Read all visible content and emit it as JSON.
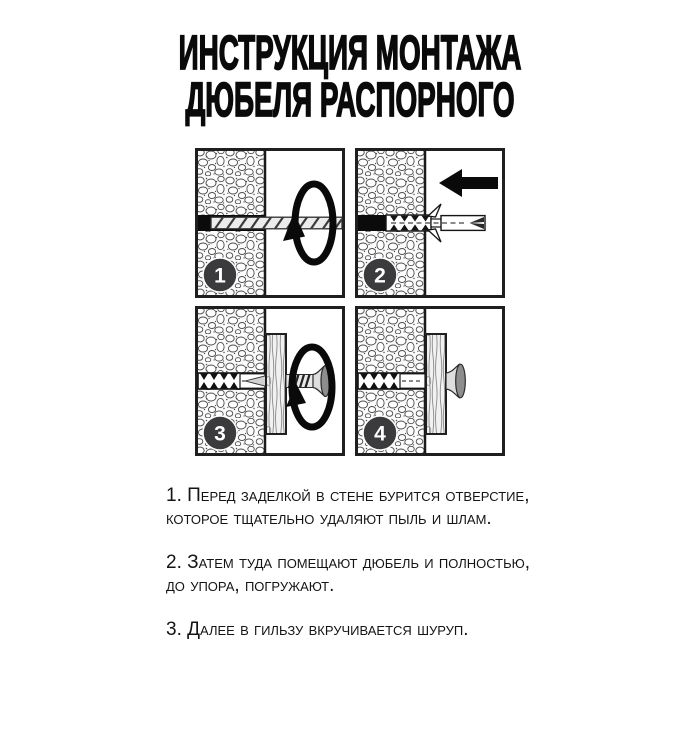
{
  "title": "ИНСТРУКЦИЯ МОНТАЖА\nДЮБЕЛЯ РАСПОРНОГО",
  "panels": [
    {
      "number": "1",
      "icon": "drill-bit-with-rotation-arrow"
    },
    {
      "number": "2",
      "icon": "dowel-with-push-arrow-left"
    },
    {
      "number": "3",
      "icon": "screw-into-dowel-with-rotation-arrow"
    },
    {
      "number": "4",
      "icon": "screw-fully-driven-flush"
    }
  ],
  "instructions": [
    "1. Перед заделкой в стене бурится отверстие,\nкоторое тщательно удаляют пыль и шлам.",
    "2. Затем туда помещают дюбель и полностью,\nдо упора, погружают.",
    "3. Далее в гильзу вкручивается шуруп."
  ],
  "colors": {
    "ink": "#0a0a0a",
    "badge": "#3b3b3d",
    "panel_border": "#1f1f1f",
    "metal_light": "#ececec",
    "metal_dark": "#8d8d8d"
  }
}
